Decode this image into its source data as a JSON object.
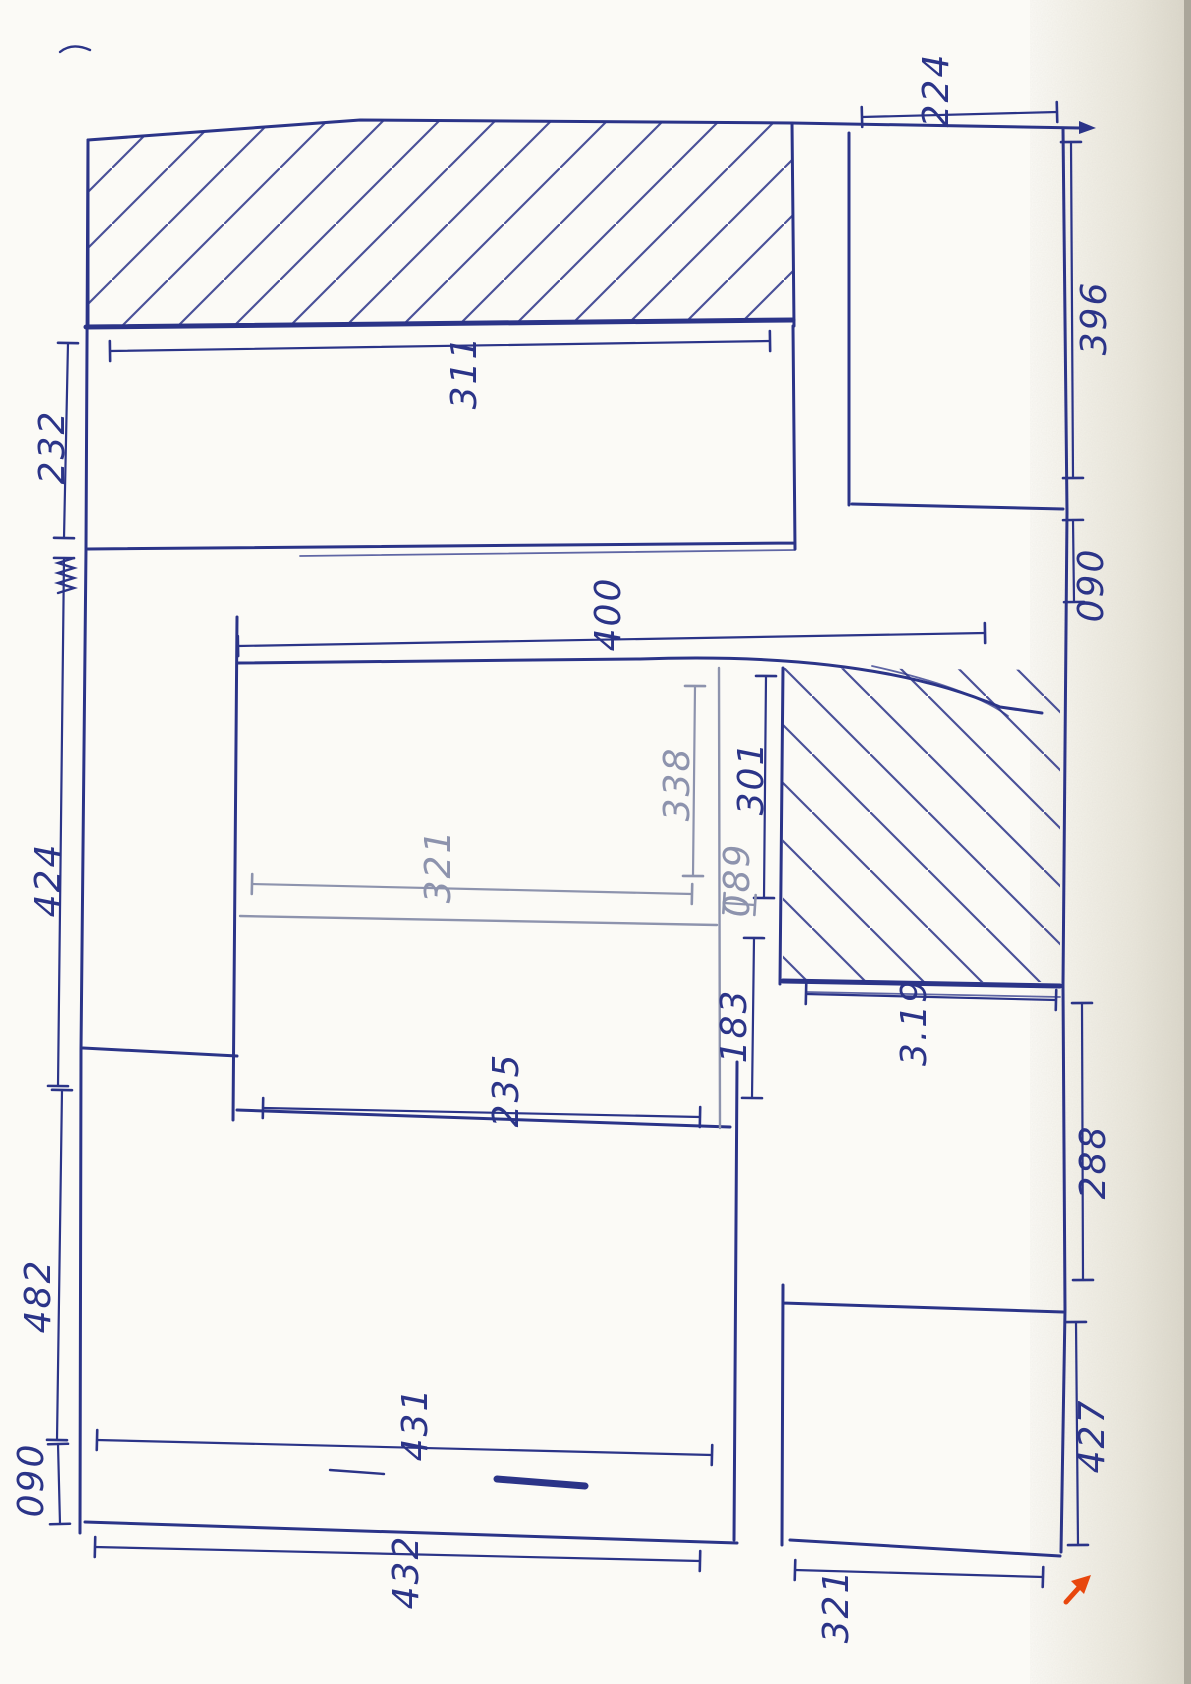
{
  "colors": {
    "ink_blue": "#2b3488",
    "ink_gray": "#8d93ad",
    "paper": "#fbfaf6",
    "scan_band": "#e7e4d9",
    "scan_edge": "#aaa69a",
    "accent_orange": "#e8470d"
  },
  "sketch": {
    "kind": "hand-drawn floor plan, rotated 90 degrees, blue ballpoint on white paper",
    "hatched_regions": [
      {
        "name": "top-wall-strip",
        "direction": "/"
      },
      {
        "name": "lower-right-block",
        "direction": "\\"
      }
    ],
    "corner_marker": {
      "type": "orange-arrow",
      "direction": "up-right"
    }
  },
  "dimensions": [
    {
      "id": "224",
      "label": "224",
      "line": [
        862,
        117,
        1057,
        112
      ],
      "label_pos": [
        938,
        90
      ],
      "color": "blue"
    },
    {
      "id": "311",
      "label": "311",
      "line": [
        110,
        351,
        770,
        341
      ],
      "label_pos": [
        466,
        372
      ],
      "color": "blue"
    },
    {
      "id": "232",
      "label": "232",
      "line": [
        68,
        343,
        64,
        538
      ],
      "label_pos": [
        54,
        447
      ],
      "color": "blue"
    },
    {
      "id": "396",
      "label": "396",
      "line": [
        1071,
        142,
        1073,
        478
      ],
      "label_pos": [
        1096,
        318
      ],
      "color": "blue"
    },
    {
      "id": "090r",
      "label": "090",
      "line": [
        1073,
        520,
        1074,
        602
      ],
      "label_pos": [
        1093,
        585
      ],
      "color": "blue"
    },
    {
      "id": "400",
      "label": "400",
      "line": [
        238,
        646,
        985,
        633
      ],
      "label_pos": [
        610,
        614
      ],
      "color": "blue"
    },
    {
      "id": "424",
      "label": "424",
      "line": [
        64,
        558,
        58,
        1086
      ],
      "label_pos": [
        50,
        880
      ],
      "color": "blue"
    },
    {
      "id": "321m",
      "label": "321",
      "line": [
        252,
        884,
        692,
        894
      ],
      "label_pos": [
        440,
        866
      ],
      "color": "gray"
    },
    {
      "id": "338",
      "label": "338",
      "line": [
        695,
        686,
        693,
        876
      ],
      "label_pos": [
        679,
        784
      ],
      "color": "gray"
    },
    {
      "id": "301",
      "label": "301",
      "line": [
        766,
        676,
        764,
        898
      ],
      "label_pos": [
        753,
        778
      ],
      "color": "blue"
    },
    {
      "id": "089",
      "label": "089",
      "line": [
        724,
        903,
        755,
        905
      ],
      "label_pos": [
        739,
        880
      ],
      "color": "gray"
    },
    {
      "id": "183",
      "label": "183",
      "line": [
        754,
        938,
        752,
        1098
      ],
      "label_pos": [
        736,
        1026
      ],
      "color": "blue"
    },
    {
      "id": "319",
      "label": "3.19",
      "line": [
        806,
        994,
        1056,
        1000
      ],
      "label_pos": [
        916,
        1022
      ],
      "color": "blue"
    },
    {
      "id": "235",
      "label": "235",
      "line": [
        263,
        1108,
        700,
        1117
      ],
      "label_pos": [
        508,
        1090
      ],
      "color": "blue"
    },
    {
      "id": "482",
      "label": "482",
      "line": [
        62,
        1090,
        57,
        1440
      ],
      "label_pos": [
        40,
        1296
      ],
      "color": "blue"
    },
    {
      "id": "090l",
      "label": "090",
      "line": [
        58,
        1444,
        60,
        1524
      ],
      "label_pos": [
        33,
        1480
      ],
      "color": "blue"
    },
    {
      "id": "431",
      "label": "431",
      "line": [
        97,
        1440,
        712,
        1455
      ],
      "label_pos": [
        417,
        1424
      ],
      "color": "blue"
    },
    {
      "id": "432",
      "label": "432",
      "line": [
        95,
        1547,
        700,
        1561
      ],
      "label_pos": [
        408,
        1572
      ],
      "color": "blue"
    },
    {
      "id": "288",
      "label": "288",
      "line": [
        1082,
        1003,
        1083,
        1280
      ],
      "label_pos": [
        1095,
        1162
      ],
      "color": "blue"
    },
    {
      "id": "427",
      "label": "427",
      "line": [
        1076,
        1322,
        1078,
        1545
      ],
      "label_pos": [
        1094,
        1436
      ],
      "color": "blue"
    },
    {
      "id": "321b",
      "label": "321",
      "line": [
        795,
        1570,
        1043,
        1577
      ],
      "label_pos": [
        838,
        1606
      ],
      "color": "blue"
    }
  ]
}
